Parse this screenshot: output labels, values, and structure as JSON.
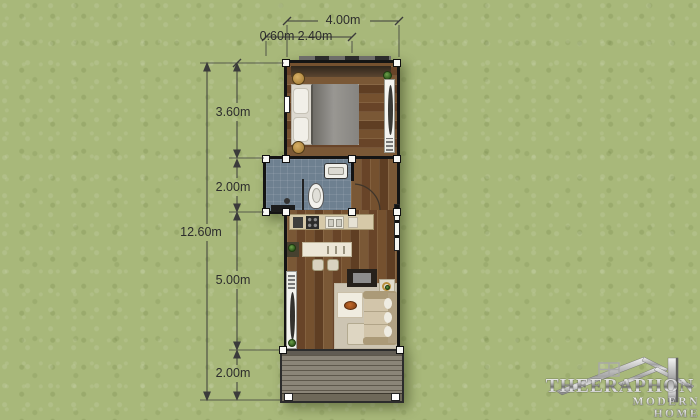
{
  "dims": {
    "top_total": "4.00m",
    "top_left": "0.60m",
    "top_mid": "2.40m",
    "side_total": "12.60m",
    "side_bedroom": "3.60m",
    "side_bath": "2.00m",
    "side_living": "5.00m",
    "side_terrace": "2.00m"
  },
  "watermark": {
    "brand": "THEERAPHON",
    "tagline": "MODERN HOME"
  },
  "colors": {
    "background": "#a8b87a",
    "wall": "#141414",
    "wood_floor": "#6f4c2d",
    "bath_floor": "#6e8090",
    "deck_floor": "#827c6f",
    "kitchen_counter": "#d6c9a8",
    "rug": "#cdc5b3",
    "plant_green": "#3f7a2e",
    "dimension_text": "#2d2d2d",
    "watermark_silver": "#cfcfcf"
  }
}
